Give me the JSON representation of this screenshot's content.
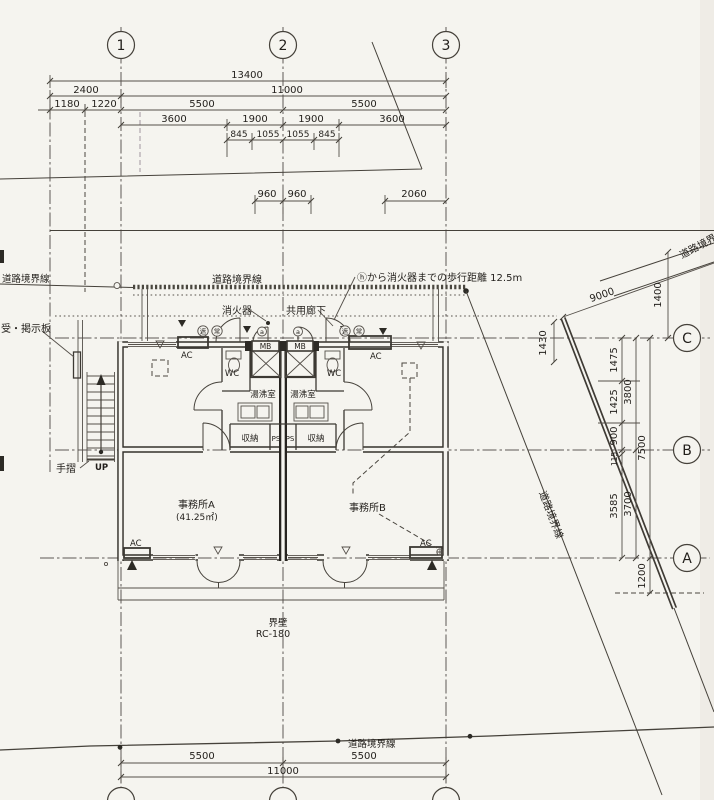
{
  "grid": {
    "cols": [
      "1",
      "2",
      "3"
    ],
    "rows": [
      "C",
      "B",
      "A"
    ]
  },
  "dims": {
    "r1": [
      "13400"
    ],
    "r2": [
      "2400",
      "11000"
    ],
    "r3": [
      "1180",
      "1220",
      "5500",
      "5500"
    ],
    "r4": [
      "3600",
      "1900",
      "1900",
      "3600"
    ],
    "r5": [
      "845",
      "1055",
      "1055",
      "845"
    ],
    "r6": [
      "960",
      "960",
      "2060"
    ],
    "right": {
      "d9000": "9000",
      "d1400": "1400",
      "d1430": "1430",
      "d1475": "1475",
      "d1425": "1425",
      "d900": "900",
      "d115": "115",
      "d3585": "3585",
      "d3800": "3800",
      "d3700": "3700",
      "d7500": "7500",
      "d1200": "1200"
    },
    "bottom": [
      "5500",
      "5500",
      "11000"
    ]
  },
  "labels": {
    "road_left": "道路境界線",
    "road_center": "道路境界線",
    "road_right": "道路境界線",
    "road_topright": "道路境界線",
    "road_bottom": "道路境界線",
    "fire_note": "ⓗから消火器までの歩行距離 12.5m",
    "fire_ext": "消火器",
    "corridor": "共用廊下",
    "board": "受・掲示板",
    "handrail": "手摺",
    "up": "UP",
    "party_wall": "界壁",
    "party_wall_spec": "RC-180",
    "ac": "AC",
    "door_tag": "a",
    "smoke_tag": "遮",
    "normal_tag": "常"
  },
  "rooms": {
    "office_a": "事務所A",
    "office_a_area": "(41.25㎡)",
    "office_b": "事務所B",
    "kitchen": "湯沸室",
    "wc": "WC",
    "mb": "MB",
    "storage": "収納",
    "ps": "PS"
  }
}
